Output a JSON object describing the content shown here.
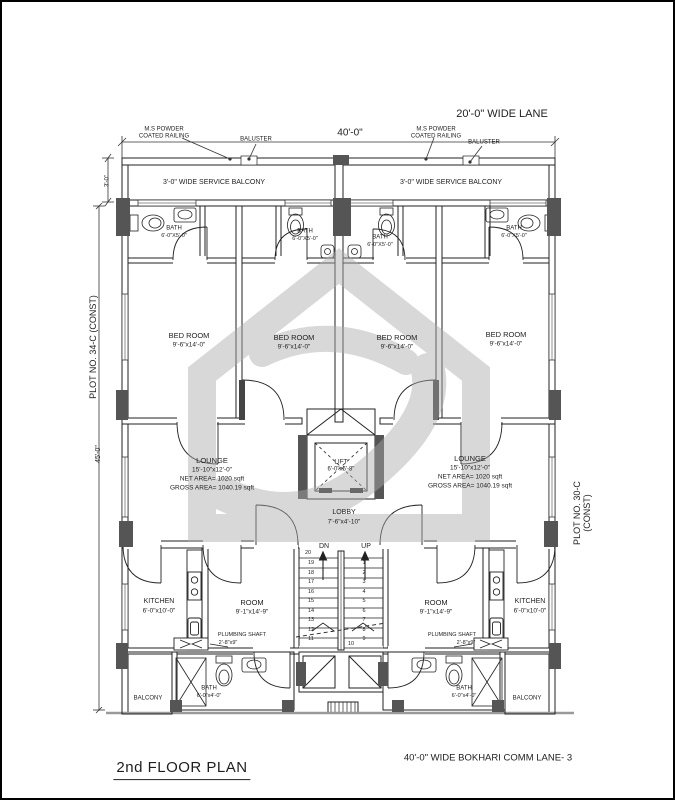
{
  "street": {
    "top_lane": "20'-0\" WIDE LANE",
    "bottom_road": "40'-0\" WIDE BOKHARI COMM LANE- 3"
  },
  "title": "2nd FLOOR PLAN",
  "plots": {
    "left": "PLOT NO. 34-C (CONST)",
    "right": "PLOT NO. 30-C (CONST)"
  },
  "dims": {
    "width_top": "40'-0\"",
    "balcony_depth": "3'-0\"",
    "side_depth": "45'-0\""
  },
  "notes": {
    "railing": "M.S POWDER\nCOATED RAILING",
    "baluster": "BALUSTER",
    "service_balcony": "3'-0\" WIDE SERVICE BALCONY"
  },
  "rooms": {
    "bath_top": {
      "name": "BATH",
      "dims": "6'-0\"X5'-0\""
    },
    "bed": {
      "name": "BED ROOM",
      "dims": "9'-6\"x14'-0\""
    },
    "lounge": {
      "name": "LOUNGE",
      "dims": "15'-10\"x12'-0\"",
      "net": "NET AREA= 1020 sqft",
      "gross": "GROSS AREA= 1040.19 sqft"
    },
    "lift": {
      "name": "LIFT",
      "dims": "6'-0\"x5'-8\""
    },
    "lobby": {
      "name": "LOBBY",
      "dims": "7'-6\"x4'-10\""
    },
    "kitchen": {
      "name": "KITCHEN",
      "dims": "6'-0\"x10'-0\""
    },
    "room": {
      "name": "ROOM",
      "dims": "9'-1\"x14'-9\""
    },
    "plumbing": {
      "name": "PLUMBING SHAFT",
      "dims": "2'-8\"x9\""
    },
    "bath_bottom": {
      "name": "BATH",
      "dims": "6'-0\"x4'-0\""
    },
    "balcony": "BALCONY"
  },
  "stairs": {
    "dn_label": "DN",
    "up_label": "UP",
    "top_number": "20",
    "bottom_number": "10",
    "left_numbers": [
      "19",
      "18",
      "17",
      "16",
      "15",
      "14",
      "13",
      "12",
      "11"
    ],
    "right_numbers": [
      "1",
      "2",
      "3",
      "4",
      "5",
      "6",
      "7",
      "8",
      "9"
    ]
  },
  "colors": {
    "line": "#222222",
    "column_fill": "#555555",
    "watermark": "#ababab",
    "ground": "#9a9a9a"
  }
}
